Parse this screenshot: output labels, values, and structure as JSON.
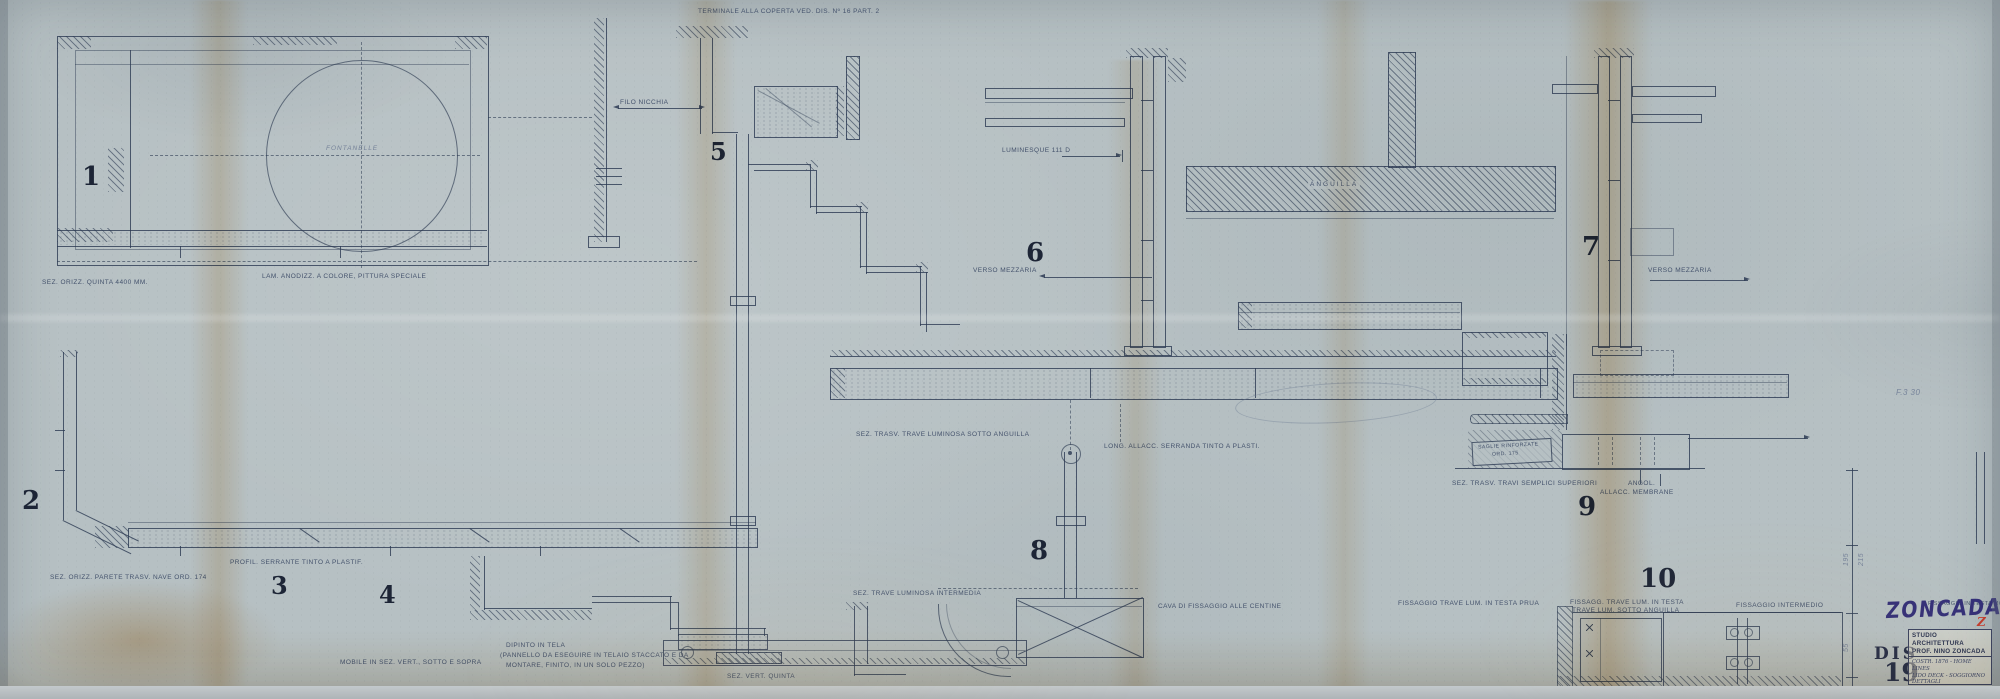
{
  "sheet": {
    "logo": "ZONCADA",
    "logo_mark": "Z"
  },
  "colors": {
    "paper": "#b6c0c3",
    "ink": "#3c4a60",
    "pencil": "#76839a",
    "logo_blue": "#332f78",
    "stamp_red": "#c23b2c",
    "stain_tan": "#d2a368"
  },
  "title_block": {
    "studio_line1": "STUDIO ARCHITETTURA",
    "studio_line2": "PROF. NINO ZONCADA",
    "project_line1": "COSTR. 1876 - HOME LINES",
    "project_line2": "LIDO DECK - SOGGIORNO",
    "project_line3": "DETTAGLI",
    "data_label": "DATA",
    "data_value": "12.05.1963",
    "scala_label": "SCALA",
    "scala_value": "1:1",
    "dis_label": "DIS. Nº",
    "dis_value": "19",
    "stamp_label": "DIS",
    "stamp_number": "19"
  },
  "detail_numbers": [
    "1",
    "2",
    "3",
    "4",
    "5",
    "6",
    "7",
    "8",
    "9",
    "10"
  ],
  "labels": [
    "TERMINALE ALLA COPERTA VED. DIS. Nº 16 PART. 2",
    "FILO NICCHIA",
    "FONTANELLE",
    "SEZ. ORIZZ. QUINTA  4400 MM.",
    "LAM. ANODIZZ. A COLORE, PITTURA SPECIALE",
    "SEZ. ORIZZ. PARETE TRASV. NAVE ORD. 174",
    "PROFIL. SERRANTE TINTO A PLASTIF.",
    "DIPINTO IN TELA",
    "(PANNELLO DA ESEGUIRE IN TELAIO STACCATO E DA",
    "MONTARE, FINITO, IN UN SOLO PEZZO)",
    "MOBILE IN SEZ. VERT., SOTTO E SOPRA",
    "SEZ. VERT. QUINTA",
    "VERSO MEZZARIA",
    "LUMINESQUE 111 D",
    "ANGUILLA",
    "VERSO MEZZARIA",
    "SEZ. TRASV. TRAVE LUMINOSA SOTTO ANGUILLA",
    "LONG. ALLACC. SERRANDA TINTO A PLASTI.",
    "SEZ. TRAVE LUMINOSA INTERMEDIA",
    "CAVA DI FISSAGGIO ALLE CENTINE",
    "SEZ. TRASV. TRAVI SEMPLICI SUPERIORI",
    "ANGOL.",
    "ALLACC. MEMBRANE",
    "SAGLIE RINFORZATE",
    "ORD. 175",
    "FISSAGGIO TRAVE LUM. IN TESTA PRUA",
    "FISSAGG. TRAVE LUM. IN TESTA",
    "TRAVE LUM. SOTTO ANGUILLA",
    "FISSAGGIO INTERMEDIO",
    "FISSAGGIO IN TESTA MOBILE",
    "F.3  30",
    "195",
    "215",
    "55"
  ]
}
